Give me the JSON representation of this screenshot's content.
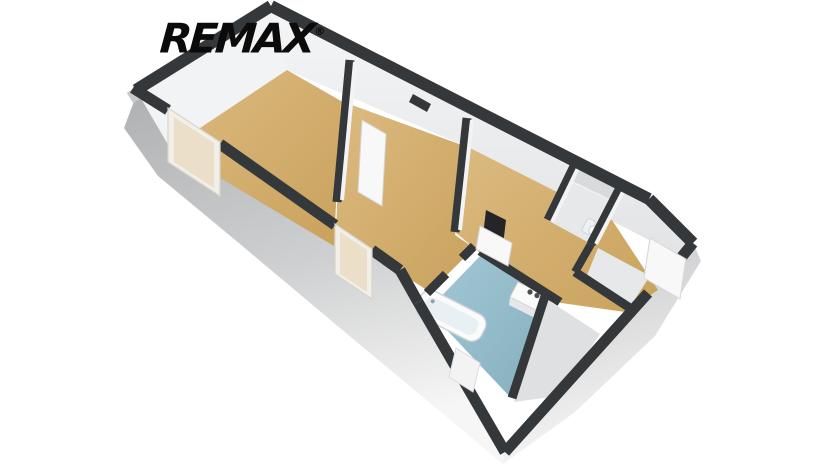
{
  "logo": {
    "text": "REMAX",
    "mark": "®"
  },
  "scene": {
    "type": "3d-floorplan-render",
    "view": "isometric bird's-eye, apartment oriented top-left to bottom-right",
    "background": "#ffffff"
  },
  "colors": {
    "background": "#ffffff",
    "logo_black": "#0b0b0b",
    "wall_top": "#35383b",
    "wall_inner": "#f2f3f4",
    "wall_inner_shade": "#e1e2e4",
    "wall_outer_top": "#b0b2b4",
    "wall_outer_fade": "#f4f4f4",
    "floor_wood": "#d2ac68",
    "floor_wood_light": "#dcba80",
    "floor_bath": "#93bccb",
    "floor_gray": "#e7e8e9",
    "window_frame": "#f2efe8",
    "window_pane": "#ebdfca",
    "door_white": "#f8f8f9",
    "fixture_white": "#fbfbfc",
    "appliance_knob": "#4a4d4f",
    "counter_gray": "#d8dadb",
    "slab_black": "#232527"
  },
  "rooms": [
    {
      "id": "room-1",
      "label": "room 1 (wood floor, window, door to room 2)"
    },
    {
      "id": "room-2",
      "label": "room 2 (wood floor, window, door to hallway)"
    },
    {
      "id": "hallway",
      "label": "hallway with kitchenette niche (wood floor)"
    },
    {
      "id": "wc",
      "label": "small room with counter and toilet (light floor)"
    },
    {
      "id": "vestibule",
      "label": "entry vestibule (light floor, open entrance door)"
    },
    {
      "id": "bathroom",
      "label": "bathroom (blue floor, bathtub)"
    }
  ],
  "fixtures": [
    {
      "id": "bathtub",
      "label": "bathtub along bathroom wall"
    },
    {
      "id": "appliance",
      "label": "white appliance with two dark knobs (cooktop/washer)"
    },
    {
      "id": "toilet",
      "label": "toilet"
    },
    {
      "id": "counter",
      "label": "countertop"
    },
    {
      "id": "window-1",
      "label": "window in room 1 outer wall"
    },
    {
      "id": "window-2",
      "label": "window in room 2 outer wall"
    },
    {
      "id": "door-1",
      "label": "open interior door room1-room2"
    },
    {
      "id": "door-2",
      "label": "open interior door room2-hallway"
    },
    {
      "id": "door-entrance",
      "label": "open entrance door"
    },
    {
      "id": "dark-slab",
      "label": "dark wall panel at hallway doorway"
    }
  ]
}
